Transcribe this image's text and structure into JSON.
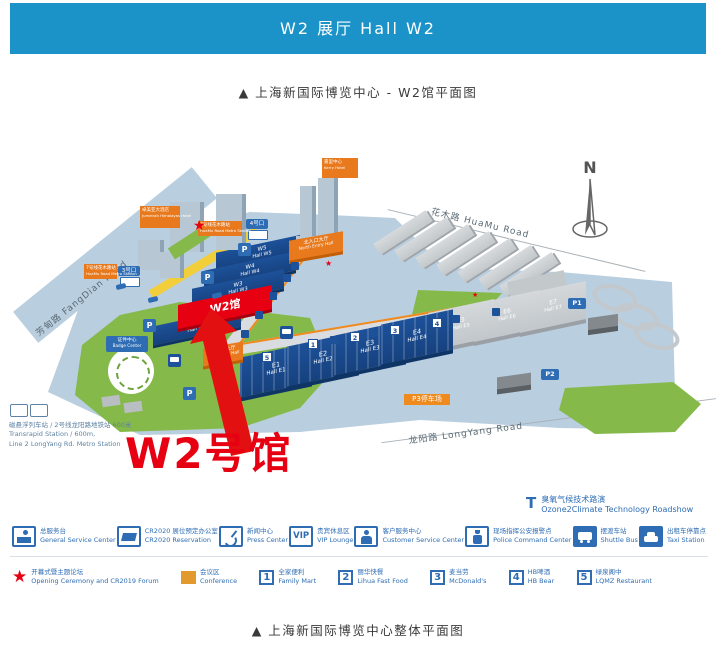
{
  "header": {
    "title": "W2 展厅  Hall W2"
  },
  "captions": {
    "top": "▲  上海新国际博览中心 - W2馆平面图",
    "bottom": "▲  上海新国际博览中心整体平面图"
  },
  "map": {
    "compass": "N",
    "roads": {
      "fangdian": "芳甸路 FangDian Road",
      "huamu": "花木路 HuaMu Road",
      "longyang": "龙阳路 LongYang Road"
    },
    "arrow_label": "W2号馆",
    "halls": {
      "w5": {
        "l1": "W5",
        "l2": "Hall W5"
      },
      "w4": {
        "l1": "W4",
        "l2": "Hall W4"
      },
      "w3": {
        "l1": "W3",
        "l2": "Hall W3"
      },
      "w2": {
        "l1": "W2馆"
      },
      "w1": {
        "l1": "W1",
        "l2": "Hall W1"
      },
      "e1": {
        "l1": "E1",
        "l2": "Hall E1"
      },
      "e2": {
        "l1": "E2",
        "l2": "Hall E2"
      },
      "e3": {
        "l1": "E3",
        "l2": "Hall E3"
      },
      "e4": {
        "l1": "E4",
        "l2": "Hall E4"
      },
      "e5": {
        "l1": "E5",
        "l2": "Hall E5"
      },
      "e6": {
        "l1": "E6",
        "l2": "Hall E6"
      },
      "e7": {
        "l1": "E7",
        "l2": "Hall E7"
      }
    },
    "entries": {
      "north": {
        "zh": "北入口大厅",
        "en": "North Entry Hall"
      },
      "west": {
        "zh": "西入口大厅",
        "en": "West Entry Hall"
      }
    },
    "badge_center": {
      "zh": "证件中心",
      "en": "Badge Center"
    },
    "hotels": {
      "jumeirah": {
        "zh": "卓美亚大酒店",
        "en": "Jumeirah Himalayas Hotel"
      },
      "kerry": {
        "zh": "嘉里中心",
        "en": "Kerry Hotel"
      }
    },
    "metro": {
      "zh": "7号线花木路站",
      "en": "HuaMu Road Metro Station"
    },
    "gates": {
      "g3": "3号口",
      "g4": "4号口"
    },
    "parking": {
      "p": "P",
      "p1": "P1",
      "p2": "P2",
      "p3": "P3停车场"
    },
    "food_markers": [
      "1",
      "2",
      "3",
      "4",
      "5"
    ],
    "transit_note": {
      "line1": "磁悬浮列车站 / 2号线龙阳路地铁站  600米",
      "line2": "Transrapid Station / 600m,",
      "line3": "Line 2 LongYang Rd. Metro Station"
    },
    "roadshow": {
      "symbol": "T",
      "zh": "臭氧气候技术路演",
      "en": "Ozone2Climate Technology Roadshow"
    }
  },
  "legend": {
    "row1": [
      {
        "zh": "总服务台",
        "en": "General Service Center"
      },
      {
        "zh": "CR2020 展位预定办公室",
        "en": "CR2020 Reservation"
      },
      {
        "zh": "新闻中心",
        "en": "Press Center"
      },
      {
        "label": "VIP",
        "zh": "贵宾休息区",
        "en": "VIP Lounge"
      },
      {
        "zh": "客户服务中心",
        "en": "Customer Service Center"
      },
      {
        "zh": "现场指挥公安报警点",
        "en": "Police Command Center"
      },
      {
        "zh": "摆渡车站",
        "en": "Shuttle Bus"
      },
      {
        "zh": "出租车停靠点",
        "en": "Taxi Station"
      }
    ],
    "row2": [
      {
        "zh": "开幕式暨主题论坛",
        "en": "Opening Ceremony and CR2019 Forum"
      },
      {
        "zh": "会议区",
        "en": "Conference"
      },
      {
        "label": "1",
        "zh": "全家便利",
        "en": "Family Mart"
      },
      {
        "label": "2",
        "zh": "丽华快餐",
        "en": "Lihua Fast Food"
      },
      {
        "label": "3",
        "zh": "麦当劳",
        "en": "McDonald's"
      },
      {
        "label": "4",
        "zh": "HB啤酒",
        "en": "HB Bear"
      },
      {
        "label": "5",
        "zh": "绿泉阁中",
        "en": "LQMZ Restaurant"
      }
    ]
  }
}
